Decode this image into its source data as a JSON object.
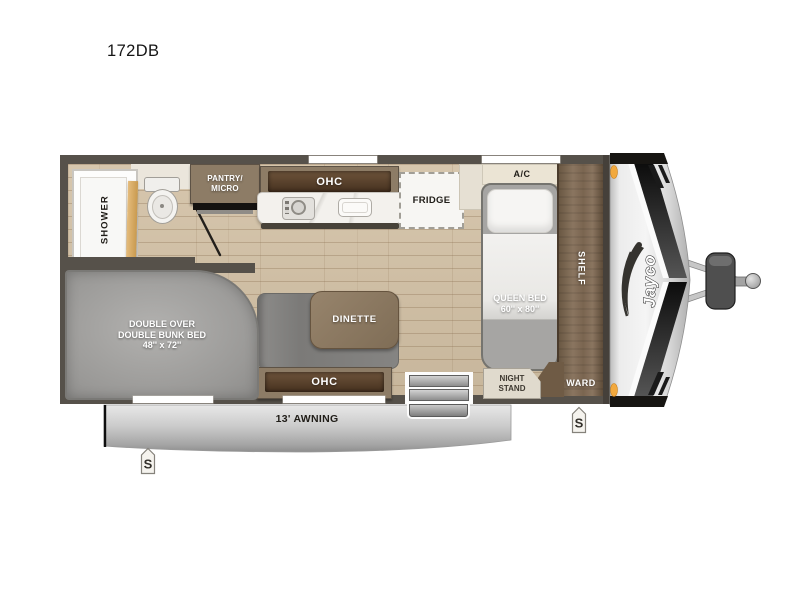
{
  "title": "172DB",
  "brand": {
    "logo": "Jayco"
  },
  "rooms": {
    "shower": "SHOWER",
    "pantry": "PANTRY/\nMICRO",
    "kitchen_ohc": "OHC",
    "fridge": "FRIDGE",
    "ac": "A/C",
    "shelf": "SHELF",
    "queen_bed": "QUEEN BED\n60'' x 80''",
    "night_stand": "NIGHT\nSTAND",
    "ward": "WARD",
    "dinette": "DINETTE",
    "dinette_ohc": "OHC",
    "bunk_bed": "DOUBLE OVER\nDOUBLE BUNK BED\n48'' x 72''"
  },
  "exterior": {
    "awning": "13' AWNING",
    "speaker_left": "S",
    "speaker_right": "S"
  },
  "colors": {
    "wall": "#56514a",
    "floor_wood": "#d2c0a4",
    "cabinet_wood": "#8d7c66",
    "cabinet_panel": "#523c2a",
    "counter": "#f3f1ed",
    "mattress_gray": "#a3a2a0",
    "bedding_white": "#f4f3f1",
    "cap_silver": "#d9d9d9",
    "clearance_amber": "#f2a93e"
  }
}
